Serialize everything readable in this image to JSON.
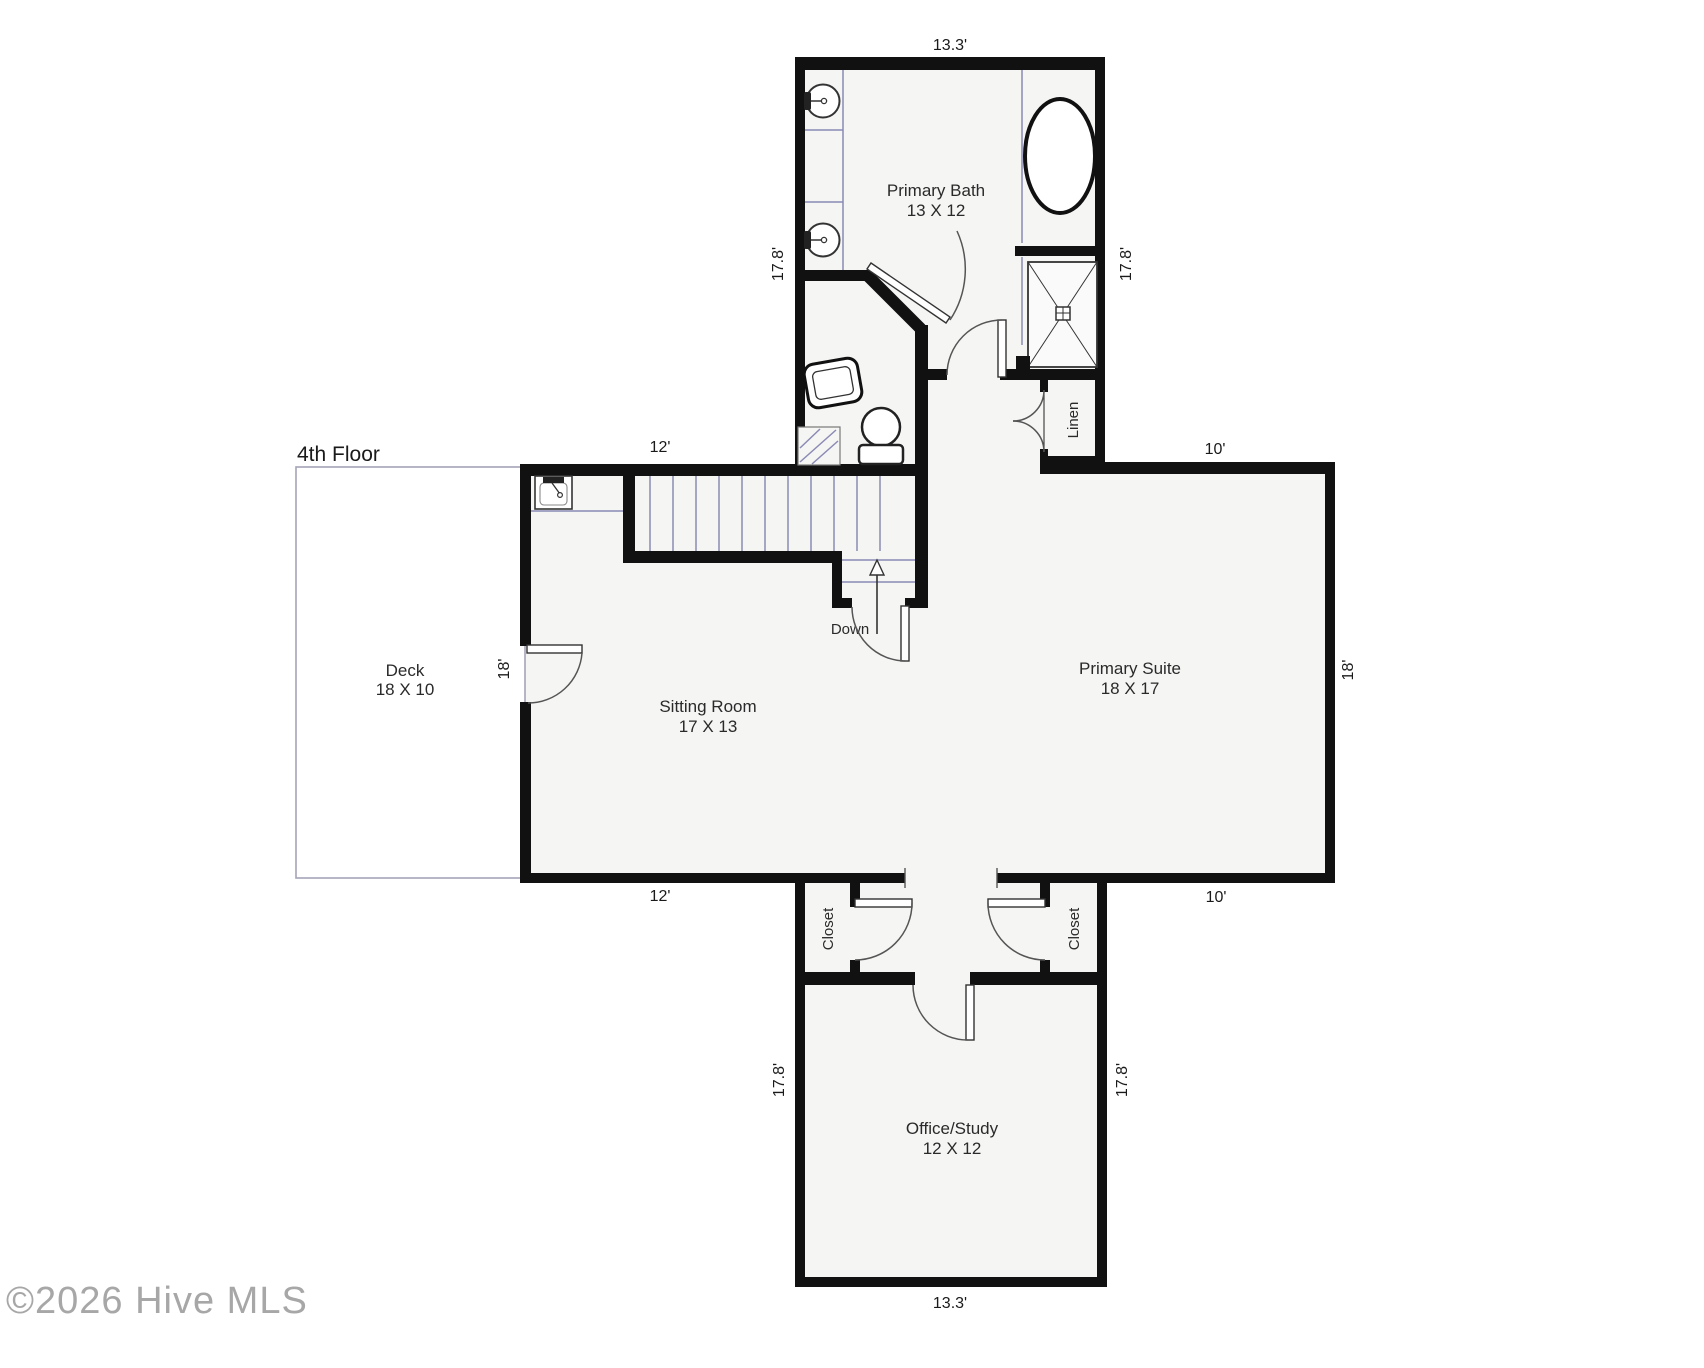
{
  "title": {
    "floor": "4th Floor"
  },
  "watermark": "©2026 Hive MLS",
  "rooms": [
    {
      "name": "Primary Bath",
      "size": "13 X 12"
    },
    {
      "name": "Sitting Room",
      "size": "17 X 13"
    },
    {
      "name": "Primary Suite",
      "size": "18 X 17"
    },
    {
      "name": "Deck",
      "size": "18 X 10"
    },
    {
      "name": "Office/Study",
      "size": "12 X 12"
    }
  ],
  "small_rooms": {
    "closet_left": "Closet",
    "closet_right": "Closet",
    "linen": "Linen"
  },
  "stairs": {
    "direction": "Down"
  },
  "dimensions": {
    "bath_top": "13.3'",
    "bath_left": "17.8'",
    "bath_right": "17.8'",
    "sitting_top": "12'",
    "suite_top": "10'",
    "sitting_left": "18'",
    "suite_right": "18'",
    "sitting_bottom": "12'",
    "suite_bottom": "10'",
    "office_left": "17.8'",
    "office_right": "17.8'",
    "office_bottom": "13.3'"
  },
  "colors": {
    "wall": "#111111",
    "floor_fill": "#f5f5f4",
    "fixture_line": "#8a8ab5",
    "text": "#1a1a1a"
  }
}
